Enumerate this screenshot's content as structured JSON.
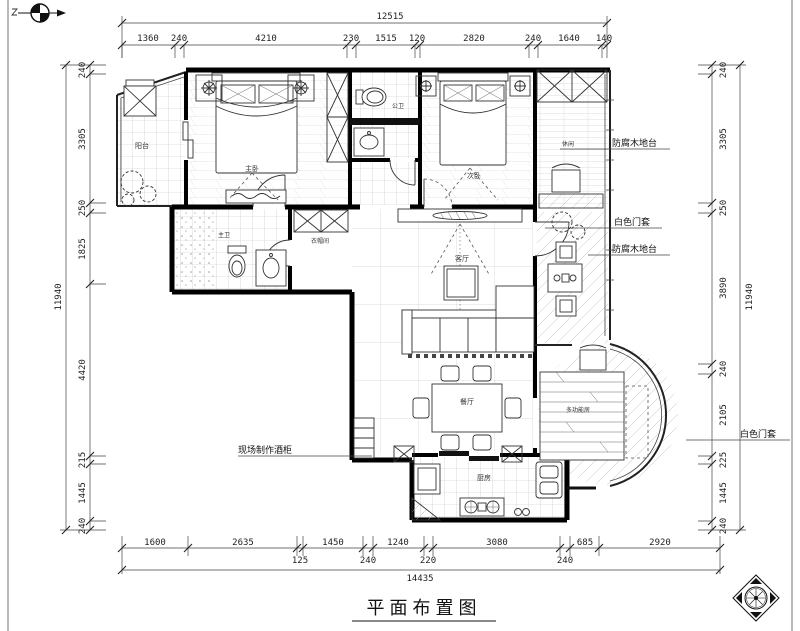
{
  "title": "平面布置图",
  "rooms": {
    "balcony": "阳台",
    "master_bedroom": "主卧",
    "public_bath": "公卫",
    "second_bedroom": "次卧",
    "leisure": "休闲",
    "master_bath": "主卫",
    "cloakroom": "衣帽间",
    "living": "客厅",
    "dining": "餐厅",
    "kitchen": "厨房",
    "multi_room": "多功能房"
  },
  "annotations": {
    "deck_top": "防腐木地台",
    "door_top": "白色门套",
    "deck_mid": "防腐木地台",
    "door_right": "白色门套",
    "wine": "现场制作酒柜"
  },
  "dims": {
    "top_total": "12515",
    "top": [
      "1360",
      "240",
      "4210",
      "230",
      "1515",
      "120",
      "2820",
      "240",
      "1640",
      "140"
    ],
    "left_total": "11940",
    "left": [
      "240",
      "3305",
      "250",
      "1825",
      "4420",
      "215",
      "1445",
      "240"
    ],
    "right_total": "11940",
    "right": [
      "240",
      "3305",
      "250",
      "3890",
      "240",
      "2105",
      "225",
      "1445",
      "240"
    ],
    "bottom": [
      "1600",
      "2635",
      "1450",
      "1240",
      "3080",
      "685",
      "2920"
    ],
    "bottom_stagger": [
      "125",
      "240",
      "220",
      "240"
    ],
    "bottom_total": "14435"
  }
}
